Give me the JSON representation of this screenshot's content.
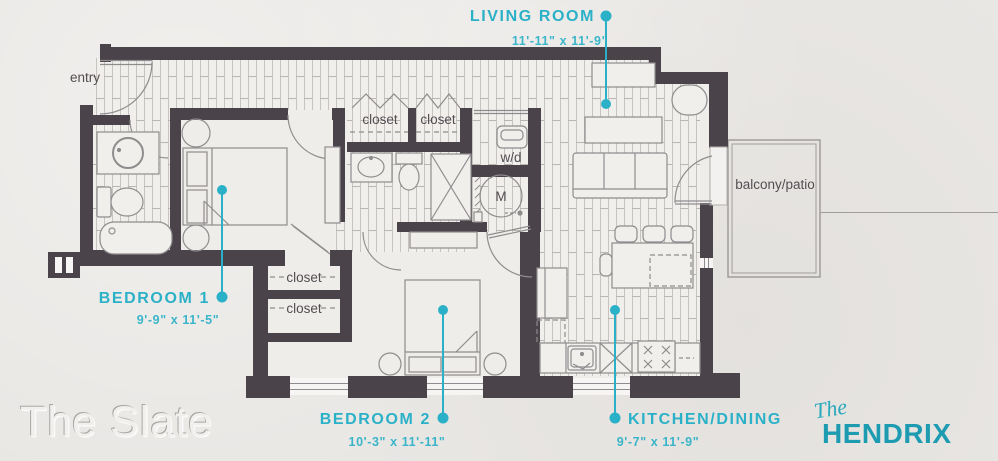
{
  "plan": {
    "rooms": [
      {
        "id": "living_room",
        "label": "LIVING ROOM",
        "dims": "11'-11\" x 11'-9\""
      },
      {
        "id": "bedroom_1",
        "label": "BEDROOM 1",
        "dims": "9'-9\" x 11'-5\""
      },
      {
        "id": "bedroom_2",
        "label": "BEDROOM 2",
        "dims": "10'-3\" x 11'-11\""
      },
      {
        "id": "kitchen_dining",
        "label": "KITCHEN/DINING",
        "dims": "9'-7\" x 11'-9\""
      }
    ],
    "annotations": {
      "entry": "entry",
      "closet": "closet",
      "washer_dryer": "w/d",
      "mechanical": "M",
      "balcony": "balcony/patio"
    }
  },
  "branding": {
    "floorplan_name": "The Slate",
    "script_prefix": "The",
    "building_name": "HENDRIX"
  },
  "colors": {
    "accent_teal": "#2bb1c7",
    "brand_teal": "#1d9cb1",
    "wall": "#4b434a",
    "background": "#e9e7e4",
    "line_gray": "#8f8c8e",
    "text_gray": "#534d52"
  }
}
